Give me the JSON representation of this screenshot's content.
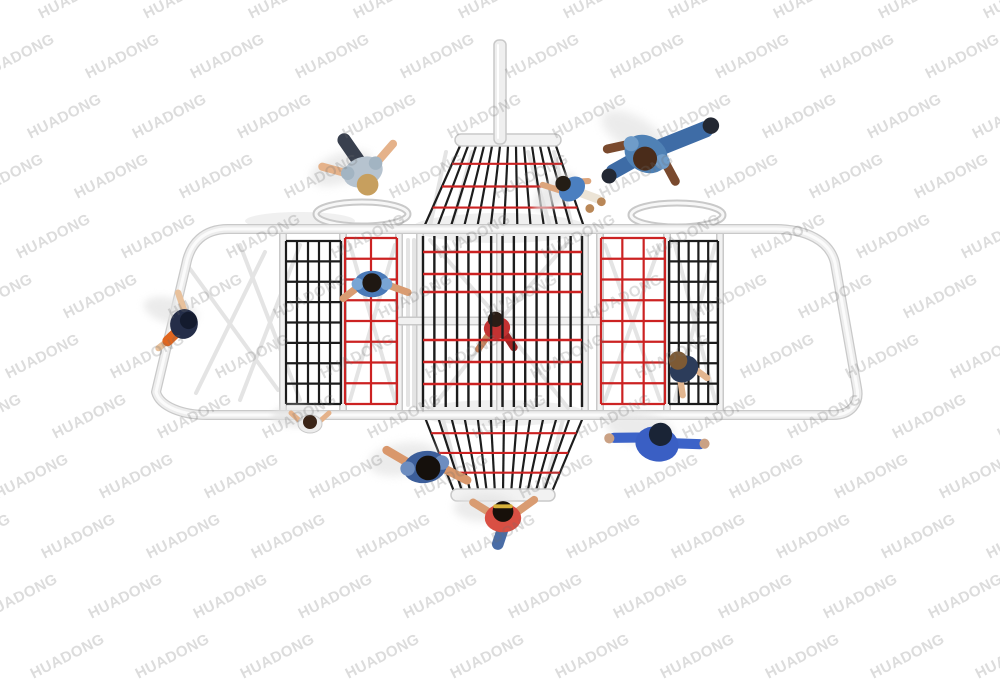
{
  "image": {
    "width": 1000,
    "height": 680,
    "background": "#ffffff",
    "description": "Top-down 3D product render of a playground rope-climbing structure with red and black net panels, white tube frame, and children playing"
  },
  "watermark": {
    "text": "HUADONG",
    "color": "rgba(110,110,110,0.24)",
    "font_size": 15,
    "rotation_deg": -27,
    "x_start": -70,
    "y_start": -12,
    "x_step": 105,
    "y_step": 60,
    "row_drift": 47,
    "cols": 12,
    "rows": 12
  },
  "colors": {
    "rope_black": "#1c1c1c",
    "rope_red": "#cc2222",
    "frame_fill": "#ededed",
    "frame_edge": "#c9c9c9",
    "frame_highlight": "#fbfbfb",
    "rail_fill": "#f1f1f1",
    "under": "#e4e4e4",
    "under_soft": "#f0f0f0",
    "shadow": "#e3e3e3"
  },
  "structure": {
    "frame_path": "M 228 229 L 775 229 C 806 229 830 241 835 263 L 857 388 C 860 403 851 415 833 415 L 207 415 C 183 415 160 407 156 392 L 186 265 C 190 243 204 229 228 229 Z",
    "mast": {
      "x": 494,
      "y": 40,
      "w": 12,
      "h": 104
    },
    "mid_beam": {
      "x1": 400,
      "x2": 600,
      "y": 321
    },
    "rails_x": [
      283,
      343,
      399,
      420,
      500,
      585,
      600,
      667,
      720
    ],
    "rails_y": [
      233,
      411
    ],
    "rings": [
      {
        "cx": 362,
        "cy": 214,
        "rx": 46,
        "ry": 12
      },
      {
        "cx": 677,
        "cy": 215,
        "rx": 46,
        "ry": 12
      }
    ],
    "soft_ellipses": [
      {
        "cx": 500,
        "cy": 228,
        "rx": 88,
        "ry": 15
      },
      {
        "cx": 500,
        "cy": 413,
        "rx": 85,
        "ry": 13
      },
      {
        "cx": 300,
        "cy": 221,
        "rx": 55,
        "ry": 9
      }
    ],
    "braces": [
      [
        240,
        245,
        300,
        400
      ],
      [
        300,
        245,
        240,
        400
      ],
      [
        350,
        245,
        395,
        400
      ],
      [
        395,
        245,
        350,
        400
      ],
      [
        408,
        240,
        408,
        405
      ],
      [
        414,
        240,
        414,
        405
      ],
      [
        430,
        240,
        500,
        320
      ],
      [
        570,
        240,
        500,
        320
      ],
      [
        432,
        408,
        500,
        322
      ],
      [
        568,
        408,
        500,
        322
      ],
      [
        446,
        152,
        430,
        226
      ],
      [
        554,
        152,
        572,
        226
      ],
      [
        472,
        152,
        452,
        226
      ],
      [
        528,
        152,
        550,
        226
      ],
      [
        605,
        245,
        660,
        400
      ],
      [
        660,
        245,
        605,
        400
      ],
      [
        675,
        245,
        715,
        400
      ],
      [
        715,
        245,
        675,
        400
      ],
      [
        442,
        416,
        462,
        490
      ],
      [
        564,
        416,
        544,
        490
      ],
      [
        185,
        262,
        278,
        390
      ],
      [
        265,
        252,
        196,
        393
      ]
    ],
    "panels": [
      {
        "name": "left-black-net",
        "x": 286,
        "y": 241,
        "w": 55,
        "h": 163,
        "v_inner": 4,
        "h_lines": 9,
        "color": "black"
      },
      {
        "name": "left-red-net",
        "x": 345,
        "y": 238,
        "w": 52,
        "h": 166,
        "v_inner": 1,
        "h_lines": 9,
        "color": "red"
      },
      {
        "name": "right-red-net",
        "x": 601,
        "y": 238,
        "w": 64,
        "h": 166,
        "v_inner": 2,
        "h_lines": 9,
        "color": "red"
      },
      {
        "name": "right-black-net",
        "x": 669,
        "y": 241,
        "w": 49,
        "h": 163,
        "v_inner": 4,
        "h_lines": 9,
        "color": "black"
      }
    ],
    "center_panel": {
      "x": 423,
      "y": 236,
      "w": 159,
      "h": 171,
      "v_lines": 15,
      "red_ys": [
        252,
        274,
        292,
        340,
        362,
        384
      ]
    },
    "funnels": [
      {
        "name": "top-funnel",
        "rim_y": 146,
        "rim_x1": 460,
        "rim_x2": 556,
        "base_y": 227,
        "base_x1": 424,
        "base_x2": 584,
        "lines": 13,
        "red_ts": [
          0.22,
          0.5,
          0.76
        ],
        "bar": {
          "x": 455,
          "y": 134,
          "w": 106,
          "h": 12
        }
      },
      {
        "name": "bottom-funnel",
        "rim_y": 494,
        "rim_x1": 455,
        "rim_x2": 551,
        "base_y": 415,
        "base_x1": 424,
        "base_x2": 584,
        "lines": 13,
        "red_ts": [
          0.27,
          0.52,
          0.77
        ],
        "bar": {
          "x": 451,
          "y": 489,
          "w": 104,
          "h": 12
        }
      }
    ]
  },
  "people": [
    {
      "name": "child-gray-jacket",
      "x": 363,
      "y": 172,
      "rot": -20,
      "s": 1.35,
      "layer": "top",
      "shadow": true,
      "parts": [
        {
          "t": "cap",
          "x1": 0,
          "y1": -8,
          "x2": -5,
          "y2": -27,
          "w": 10,
          "c": "#39404e"
        },
        {
          "t": "cap",
          "x1": -10,
          "y1": -2,
          "x2": -27,
          "y2": -14,
          "w": 6,
          "c": "#e5b28a"
        },
        {
          "t": "cap",
          "x1": 10,
          "y1": -2,
          "x2": 28,
          "y2": -12,
          "w": 6,
          "c": "#e5b28a"
        },
        {
          "t": "ell",
          "x": 0,
          "y": 0,
          "rx": 15,
          "ry": 11,
          "c": "#b6c3cf"
        },
        {
          "t": "cir",
          "x": -11,
          "y": -3,
          "r": 5,
          "c": "#a2b4c2"
        },
        {
          "t": "cir",
          "x": 11,
          "y": -3,
          "r": 5,
          "c": "#a2b4c2"
        },
        {
          "t": "cir",
          "x": 0,
          "y": 10,
          "r": 8,
          "c": "#c79f5e"
        }
      ]
    },
    {
      "name": "child-denim-outfit",
      "x": 646,
      "y": 154,
      "rot": 30,
      "s": 1.5,
      "layer": "top",
      "shadow": true,
      "parts": [
        {
          "t": "cap",
          "x1": 4,
          "y1": -6,
          "x2": 26,
          "y2": -34,
          "w": 11,
          "c": "#3e6ca6"
        },
        {
          "t": "cir",
          "x": 28,
          "y": -38,
          "r": 5.5,
          "c": "#232833"
        },
        {
          "t": "cap",
          "x1": -4,
          "y1": 6,
          "x2": -13,
          "y2": 21,
          "w": 10,
          "c": "#3e6ca6"
        },
        {
          "t": "cir",
          "x": -14,
          "y": 25,
          "r": 5,
          "c": "#232833"
        },
        {
          "t": "cap",
          "x1": -13,
          "y1": 0,
          "x2": -24,
          "y2": 10,
          "w": 6,
          "c": "#7a4a2e"
        },
        {
          "t": "cap",
          "x1": 13,
          "y1": -2,
          "x2": 26,
          "y2": 6,
          "w": 6,
          "c": "#7a4a2e"
        },
        {
          "t": "ell",
          "x": 0,
          "y": 0,
          "rx": 15,
          "ry": 12,
          "c": "#4f81b5"
        },
        {
          "t": "cir",
          "x": -12,
          "y": -1,
          "r": 5,
          "c": "#6f9cc9"
        },
        {
          "t": "cir",
          "x": 12,
          "y": -1,
          "r": 5,
          "c": "#6f9cc9"
        },
        {
          "t": "cir",
          "x": 1,
          "y": 3,
          "r": 8,
          "c": "#4a2c1a"
        }
      ]
    },
    {
      "name": "child-blue-top-sandals",
      "x": 572,
      "y": 189,
      "rot": -40,
      "s": 1.1,
      "layer": "top",
      "shadow": true,
      "parts": [
        {
          "t": "cap",
          "x1": -8,
          "y1": -4,
          "x2": -18,
          "y2": -20,
          "w": 5.5,
          "c": "#dca57c"
        },
        {
          "t": "cap",
          "x1": 8,
          "y1": -2,
          "x2": 16,
          "y2": 4,
          "w": 5.5,
          "c": "#dca57c"
        },
        {
          "t": "cap",
          "x1": 4,
          "y1": 8,
          "x2": 12,
          "y2": 22,
          "w": 8,
          "c": "#ece4d6"
        },
        {
          "t": "cir",
          "x": 13,
          "y": 26,
          "r": 4,
          "c": "#b98757"
        },
        {
          "t": "cir",
          "x": 1,
          "y": 24,
          "r": 4,
          "c": "#b98757"
        },
        {
          "t": "ell",
          "x": 0,
          "y": 0,
          "rx": 13,
          "ry": 10,
          "c": "#4b7fc0"
        },
        {
          "t": "cir",
          "x": -3,
          "y": -9,
          "r": 7,
          "c": "#241d15"
        }
      ]
    },
    {
      "name": "child-navy-orange-climber",
      "x": 184,
      "y": 324,
      "rot": 15,
      "s": 1.15,
      "layer": "top",
      "shadow": true,
      "parts": [
        {
          "t": "cap",
          "x1": -2,
          "y1": -10,
          "x2": -12,
          "y2": -25,
          "w": 5.5,
          "c": "#e8c19c"
        },
        {
          "t": "cap",
          "x1": -4,
          "y1": 10,
          "x2": -16,
          "y2": 26,
          "w": 5.5,
          "c": "#e8c19c"
        },
        {
          "t": "cap",
          "x1": -4,
          "y1": 8,
          "x2": -10,
          "y2": 18,
          "w": 9,
          "c": "#e0661f"
        },
        {
          "t": "ell",
          "x": 0,
          "y": 0,
          "rx": 12,
          "ry": 13,
          "c": "#252e49"
        },
        {
          "t": "cir",
          "x": 3,
          "y": -4,
          "r": 7.5,
          "c": "#141b2e"
        }
      ]
    },
    {
      "name": "child-blue-shirt-on-net",
      "x": 372,
      "y": 284,
      "rot": 0,
      "s": 1.2,
      "layer": "top",
      "shadow": false,
      "parts": [
        {
          "t": "cap",
          "x1": -11,
          "y1": 2,
          "x2": -24,
          "y2": 12,
          "w": 6,
          "c": "#d99c72"
        },
        {
          "t": "cap",
          "x1": 11,
          "y1": 0,
          "x2": 30,
          "y2": 7,
          "w": 6,
          "c": "#d99c72"
        },
        {
          "t": "ell",
          "x": 0,
          "y": 0,
          "rx": 15,
          "ry": 11,
          "c": "#4a7ab8"
        },
        {
          "t": "cir",
          "x": -12,
          "y": 0,
          "r": 5,
          "c": "#79a5d4"
        },
        {
          "t": "cir",
          "x": 12,
          "y": 0,
          "r": 5,
          "c": "#79a5d4"
        },
        {
          "t": "cir",
          "x": 0,
          "y": -1,
          "r": 8,
          "c": "#1f1812"
        }
      ]
    },
    {
      "name": "child-red-inside-tower",
      "x": 497,
      "y": 328,
      "rot": -10,
      "s": 1.1,
      "layer": "under",
      "shadow": false,
      "parts": [
        {
          "t": "cap",
          "x1": -8,
          "y1": 4,
          "x2": -20,
          "y2": 16,
          "w": 6,
          "c": "#c9855f"
        },
        {
          "t": "cap",
          "x1": 6,
          "y1": 6,
          "x2": 12,
          "y2": 20,
          "w": 7,
          "c": "#a02525"
        },
        {
          "t": "ell",
          "x": 0,
          "y": 0,
          "rx": 12,
          "ry": 10,
          "c": "#c23232"
        },
        {
          "t": "cir",
          "x": 0,
          "y": -8,
          "r": 7,
          "c": "#2a1d16"
        }
      ]
    },
    {
      "name": "child-navy-top-on-net",
      "x": 684,
      "y": 369,
      "rot": -35,
      "s": 1.15,
      "layer": "top",
      "shadow": false,
      "parts": [
        {
          "t": "cap",
          "x1": -8,
          "y1": 6,
          "x2": -14,
          "y2": 18,
          "w": 5.5,
          "c": "#e3b68f"
        },
        {
          "t": "cap",
          "x1": 8,
          "y1": 6,
          "x2": 12,
          "y2": 18,
          "w": 5.5,
          "c": "#e3b68f"
        },
        {
          "t": "ell",
          "x": 0,
          "y": 0,
          "rx": 13,
          "ry": 11,
          "c": "#2c3c5a"
        },
        {
          "t": "cir",
          "x": 0,
          "y": -9,
          "r": 8,
          "c": "#7d5a35"
        }
      ]
    },
    {
      "name": "child-white-top",
      "x": 310,
      "y": 424,
      "rot": 0,
      "s": 1.0,
      "layer": "top",
      "shadow": true,
      "parts": [
        {
          "t": "cap",
          "x1": -9,
          "y1": -2,
          "x2": -19,
          "y2": -11,
          "w": 5,
          "c": "#e5b28a"
        },
        {
          "t": "cap",
          "x1": 9,
          "y1": -2,
          "x2": 19,
          "y2": -11,
          "w": 5,
          "c": "#e5b28a"
        },
        {
          "t": "ell",
          "x": 0,
          "y": 0,
          "rx": 12,
          "ry": 9,
          "c": "#ececec",
          "sc": "#c9c9c9"
        },
        {
          "t": "cir",
          "x": 0,
          "y": -2,
          "r": 7,
          "c": "#3a2417"
        }
      ]
    },
    {
      "name": "child-striped-shirt",
      "x": 425,
      "y": 467,
      "rot": -10,
      "s": 1.45,
      "layer": "top",
      "shadow": true,
      "parts": [
        {
          "t": "cap",
          "x1": -10,
          "y1": -4,
          "x2": -24,
          "y2": -16,
          "w": 6,
          "c": "#d9976b"
        },
        {
          "t": "cap",
          "x1": 11,
          "y1": 2,
          "x2": 27,
          "y2": 14,
          "w": 6,
          "c": "#d9976b"
        },
        {
          "t": "ell",
          "x": 0,
          "y": 0,
          "rx": 15,
          "ry": 11,
          "c": "#3c5e9a"
        },
        {
          "t": "cir",
          "x": -12,
          "y": -1,
          "r": 5,
          "c": "#6d8dc0"
        },
        {
          "t": "cir",
          "x": 12,
          "y": -1,
          "r": 5,
          "c": "#6d8dc0"
        },
        {
          "t": "cir",
          "x": 2,
          "y": 1,
          "r": 8.5,
          "c": "#15100c"
        }
      ]
    },
    {
      "name": "child-red-shirt-at-rim",
      "x": 503,
      "y": 518,
      "rot": 0,
      "s": 1.3,
      "layer": "top",
      "shadow": true,
      "parts": [
        {
          "t": "cap",
          "x1": -10,
          "y1": -4,
          "x2": -23,
          "y2": -12,
          "w": 6,
          "c": "#d99c72"
        },
        {
          "t": "cap",
          "x1": 10,
          "y1": -4,
          "x2": 24,
          "y2": -14,
          "w": 6,
          "c": "#d99c72"
        },
        {
          "t": "cap",
          "x1": 0,
          "y1": 8,
          "x2": -4,
          "y2": 20,
          "w": 9,
          "c": "#4a6da6"
        },
        {
          "t": "ell",
          "x": 0,
          "y": 0,
          "rx": 14,
          "ry": 11,
          "c": "#d94f43"
        },
        {
          "t": "cir",
          "x": 0,
          "y": -5,
          "r": 8,
          "c": "#17100a"
        },
        {
          "t": "cap",
          "x1": -6,
          "y1": -9,
          "x2": 6,
          "y2": -9,
          "w": 3,
          "c": "#d8b23a"
        }
      ]
    },
    {
      "name": "child-blue-jacket-arms-spread",
      "x": 657,
      "y": 444,
      "rot": 12,
      "s": 1.45,
      "layer": "top",
      "shadow": true,
      "parts": [
        {
          "t": "cap",
          "x1": -12,
          "y1": -2,
          "x2": -30,
          "y2": 2,
          "w": 7,
          "c": "#3c63c8"
        },
        {
          "t": "cap",
          "x1": 12,
          "y1": -3,
          "x2": 29,
          "y2": -6,
          "w": 7,
          "c": "#3c63c8"
        },
        {
          "t": "cir",
          "x": -33,
          "y": 3,
          "r": 3.5,
          "c": "#caa184"
        },
        {
          "t": "cir",
          "x": 32,
          "y": -7,
          "r": 3.5,
          "c": "#caa184"
        },
        {
          "t": "ell",
          "x": 0,
          "y": 0,
          "rx": 15,
          "ry": 12,
          "c": "#3a5fc4"
        },
        {
          "t": "cir",
          "x": 1,
          "y": -7,
          "r": 8,
          "c": "#1a2436"
        }
      ]
    }
  ]
}
